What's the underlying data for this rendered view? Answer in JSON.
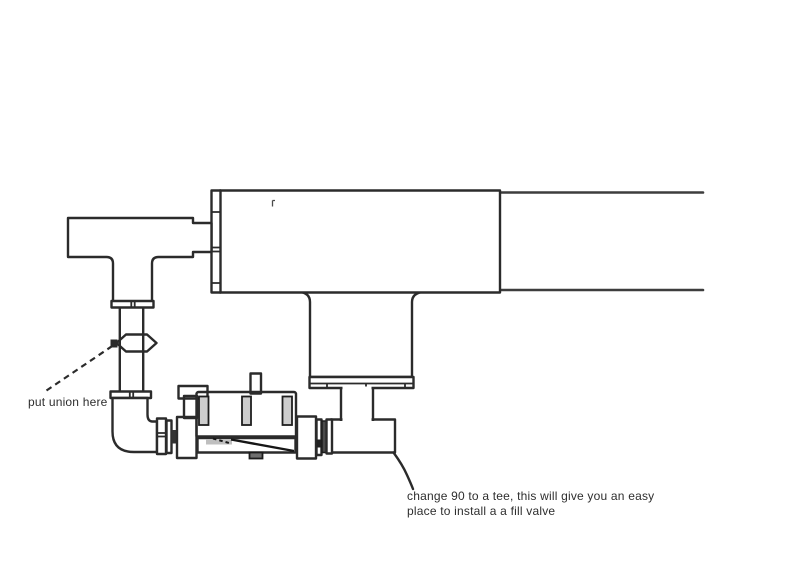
{
  "annotations": {
    "union_note": "put union here",
    "tee_note_line1": "change 90 to a tee, this will give you an easy",
    "tee_note_line2": "place to install a a fill valve"
  },
  "colors": {
    "background": "#ffffff",
    "line": "#2b2b2b",
    "pipe_line": "#3d3d3d",
    "pump_body": "#9f9f9f",
    "pump_light": "#cdcdcd",
    "pump_dark": "#8c8c8c",
    "pump_darker": "#6f6f6f",
    "nut": "#939393",
    "ledge": "#aaaaaa",
    "text": "#2e2e2e"
  },
  "parts": {
    "tank": "heater-tank-body",
    "outlet": "outlet-pipe",
    "tee": "tee-fitting",
    "union": "union-fitting",
    "elbow": "ninety-elbow-fitting",
    "pump": "pump-assembly",
    "flange": "tank-flange",
    "neck": "tank-inlet-neck",
    "discharge": "discharge-pipe",
    "suction": "suction-pipe"
  }
}
